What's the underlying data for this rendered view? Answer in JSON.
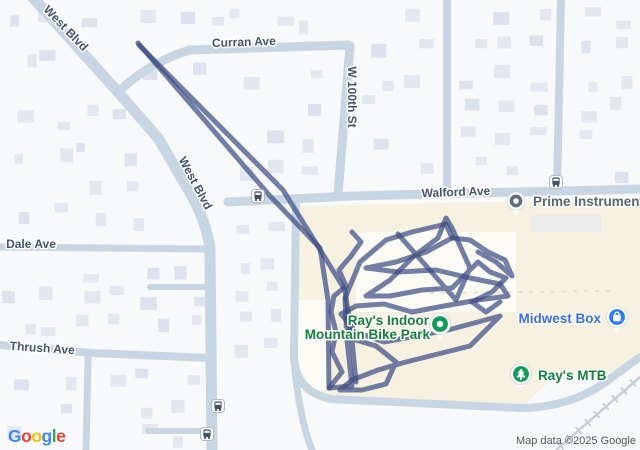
{
  "map": {
    "attribution": "Map data ©2025 Google",
    "google_logo": {
      "letters": [
        {
          "ch": "G",
          "color": "#4285F4"
        },
        {
          "ch": "o",
          "color": "#EA4335"
        },
        {
          "ch": "o",
          "color": "#FBBC05"
        },
        {
          "ch": "g",
          "color": "#4285F4"
        },
        {
          "ch": "l",
          "color": "#34A853"
        },
        {
          "ch": "e",
          "color": "#EA4335"
        }
      ]
    },
    "colors": {
      "bg": "#f8f9fa",
      "building": "#e3e7f0",
      "building_alt": "#dde2ee",
      "road": "#c8d6e4",
      "cream": "#f6f1e1",
      "white_patch": "#fbfbf8",
      "gray_building": "#ebecec",
      "rail": "#c7ccd6",
      "track": "#3d4e85",
      "street_label": "#44546e",
      "stop_border": "#aeb9c6",
      "stop_glyph": "#44536b"
    },
    "street_labels": [
      {
        "id": "west-blvd-upper",
        "text": "West Blvd",
        "x": 63,
        "y": 31,
        "rot": 46
      },
      {
        "id": "curran-ave",
        "text": "Curran Ave",
        "x": 244,
        "y": 46,
        "rot": -2
      },
      {
        "id": "west-blvd-lower",
        "text": "West Blvd",
        "x": 192,
        "y": 185,
        "rot": 62
      },
      {
        "id": "w-100th-st",
        "text": "W 100th St",
        "x": 348,
        "y": 97,
        "rot": 90
      },
      {
        "id": "walford-ave",
        "text": "Walford Ave",
        "x": 456,
        "y": 196,
        "rot": -2
      },
      {
        "id": "dale-ave",
        "text": "Dale Ave",
        "x": 31,
        "y": 248,
        "rot": 0
      },
      {
        "id": "thrush-ave",
        "text": "Thrush Ave",
        "x": 42,
        "y": 352,
        "rot": 4
      }
    ],
    "pois": [
      {
        "id": "prime-instrument",
        "label": "Prime Instrument",
        "label_color": "#5b6570",
        "pin": "dot",
        "pin_color": "#5f6e7e",
        "x": 516,
        "y": 201,
        "lx": 533,
        "ly": 206,
        "anchor": "start"
      },
      {
        "id": "midwest-box",
        "label": "Midwest Box",
        "label_color": "#3a6fe8",
        "pin": "bag",
        "pin_color": "#2e7cf6",
        "x": 617,
        "y": 317,
        "lx": 601,
        "ly": 323,
        "anchor": "end"
      },
      {
        "id": "rays-mtb",
        "label": "Ray's MTB",
        "label_color": "#12803c",
        "pin": "tree",
        "pin_color": "#0f9d58",
        "x": 521,
        "y": 374,
        "lx": 538,
        "ly": 380,
        "anchor": "start"
      },
      {
        "id": "rays-indoor",
        "label": "Ray's Indoor",
        "label2": "Mountain Bike Park",
        "label_color": "#12803c",
        "pin": "dot-green",
        "pin_color": "#0f9d58",
        "x": 440,
        "y": 324,
        "lx": 429,
        "ly": 325,
        "anchor": "end"
      }
    ],
    "transit_stops": [
      [
        258,
        196
      ],
      [
        556,
        182
      ],
      [
        218,
        406
      ],
      [
        207,
        434
      ]
    ],
    "roads": [
      {
        "id": "west-blvd",
        "d": "M 28,-8 L 118,92 L 158,138 L 192,196 Q 206,222 210,248 L 212,450",
        "w": 11
      },
      {
        "id": "curran-ave",
        "d": "M 118,92 Q 150,62 190,50 L 348,45",
        "w": 9
      },
      {
        "id": "w-100th-st",
        "d": "M 350,46 L 338,194",
        "w": 9
      },
      {
        "id": "walford-ave",
        "d": "M 228,202 L 352,196 L 640,189",
        "w": 9
      },
      {
        "id": "north-street-a",
        "d": "M 447,0 L 447,192",
        "w": 8
      },
      {
        "id": "north-street-b",
        "d": "M 561,0 L 557,191",
        "w": 8
      },
      {
        "id": "dale-ave",
        "d": "M 0,247 L 208,249",
        "w": 7
      },
      {
        "id": "dale-stub",
        "d": "M 150,287 L 212,287",
        "w": 6
      },
      {
        "id": "thrush-ave",
        "d": "M 0,345 L 92,353 L 210,358",
        "w": 8
      },
      {
        "id": "south-side-street",
        "d": "M 88,358 L 86,450",
        "w": 7
      },
      {
        "id": "south-stub",
        "d": "M 148,431 L 212,431",
        "w": 6
      },
      {
        "id": "rays-access-road",
        "d": "M 296,198 L 294,355 Q 294,390 330,399 L 520,408 Q 575,408 615,375 L 640,357",
        "w": 8
      },
      {
        "id": "rays-south-branch",
        "d": "M 295,370 Q 300,420 312,450",
        "w": 7
      }
    ],
    "railroad": {
      "x1": 556,
      "y1": 450,
      "x2": 640,
      "y2": 377
    },
    "areas": {
      "cream": "M 298,206 L 640,199 L 640,352 L 612,372 L 560,372 L 522,406 L 338,402 L 300,392 L 294,360 L 294,206 Z",
      "white_patches": [
        [
          297,
          300,
          30,
          90
        ],
        [
          356,
          232,
          160,
          80
        ]
      ],
      "gray_buildings": [
        [
          531,
          215,
          70,
          17
        ]
      ]
    },
    "track": {
      "opacity": 0.72,
      "width": 5,
      "paths": [
        [
          [
            138,
            43
          ],
          [
            270,
            196
          ],
          [
            320,
            248
          ],
          [
            328,
            300
          ],
          [
            329,
            388
          ],
          [
            352,
            386
          ],
          [
            347,
            340
          ],
          [
            345,
            300
          ]
        ],
        [
          [
            139,
            45
          ],
          [
            283,
            190
          ],
          [
            345,
            290
          ],
          [
            352,
            340
          ],
          [
            356,
            382
          ]
        ],
        [
          [
            345,
            298
          ],
          [
            360,
            262
          ],
          [
            386,
            240
          ],
          [
            412,
            232
          ],
          [
            446,
            224
          ],
          [
            452,
            238
          ],
          [
            426,
            252
          ],
          [
            396,
            262
          ],
          [
            366,
            268
          ],
          [
            398,
            272
          ],
          [
            436,
            270
          ],
          [
            470,
            278
          ],
          [
            500,
            284
          ],
          [
            508,
            296
          ],
          [
            478,
            300
          ],
          [
            444,
            306
          ],
          [
            412,
            312
          ],
          [
            384,
            304
          ],
          [
            356,
            306
          ],
          [
            341,
            314
          ],
          [
            356,
            332
          ],
          [
            384,
            342
          ],
          [
            416,
            336
          ],
          [
            448,
            330
          ],
          [
            478,
            322
          ],
          [
            500,
            316
          ],
          [
            470,
            346
          ],
          [
            438,
            354
          ],
          [
            406,
            362
          ],
          [
            378,
            370
          ],
          [
            352,
            380
          ],
          [
            340,
            390
          ],
          [
            362,
            390
          ],
          [
            386,
            384
          ],
          [
            396,
            362
          ],
          [
            376,
            346
          ],
          [
            356,
            340
          ],
          [
            346,
            320
          ]
        ],
        [
          [
            398,
            234
          ],
          [
            428,
            268
          ],
          [
            456,
            300
          ],
          [
            470,
            268
          ],
          [
            452,
            228
          ],
          [
            446,
            218
          ],
          [
            438,
            238
          ],
          [
            414,
            256
          ],
          [
            390,
            280
          ],
          [
            366,
            296
          ],
          [
            390,
            296
          ],
          [
            422,
            290
          ],
          [
            452,
            288
          ],
          [
            478,
            262
          ],
          [
            490,
            272
          ],
          [
            506,
            278
          ],
          [
            492,
            292
          ],
          [
            472,
            302
          ],
          [
            486,
            312
          ],
          [
            500,
            302
          ]
        ],
        [
          [
            452,
            238
          ],
          [
            470,
            240
          ],
          [
            488,
            252
          ],
          [
            505,
            260
          ],
          [
            512,
            276
          ],
          [
            496,
            262
          ],
          [
            478,
            252
          ]
        ],
        [
          [
            329,
            388
          ],
          [
            342,
            372
          ],
          [
            332,
            352
          ],
          [
            336,
            332
          ],
          [
            331,
            312
          ],
          [
            334,
            296
          ],
          [
            346,
            286
          ],
          [
            339,
            270
          ],
          [
            351,
            256
          ],
          [
            361,
            242
          ],
          [
            352,
            232
          ]
        ]
      ]
    }
  }
}
